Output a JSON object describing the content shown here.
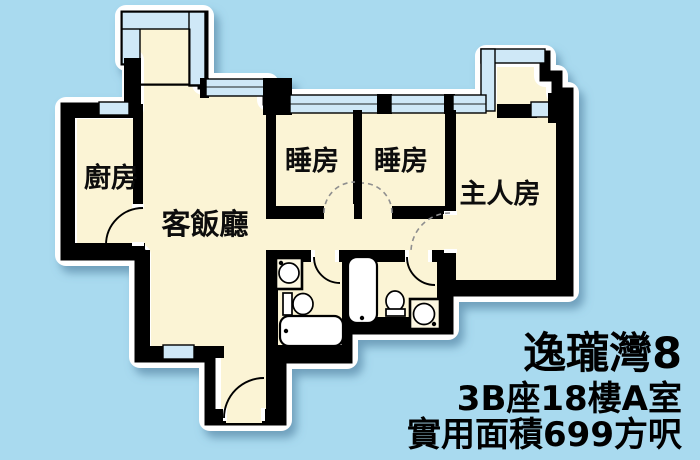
{
  "background_color": "#a9daef",
  "plan": {
    "floor_color": "#fbf4d5",
    "wall_color": "#000000",
    "window_glass_color": "#cfe8f7",
    "outline_color": "#ffffff",
    "rooms": [
      {
        "id": "kitchen",
        "label": "廚房"
      },
      {
        "id": "living-dining",
        "label": "客飯廳"
      },
      {
        "id": "bedroom-1",
        "label": "睡房"
      },
      {
        "id": "bedroom-2",
        "label": "睡房"
      },
      {
        "id": "master-bedroom",
        "label": "主人房"
      }
    ],
    "fixtures": [
      "bathtub",
      "toilet",
      "wash-basin",
      "bathtub",
      "toilet",
      "wash-basin"
    ],
    "features": [
      "balcony-bay-window",
      "windows",
      "entrance-door",
      "room-doors"
    ]
  },
  "caption": {
    "title": "逸瓏灣8",
    "block_floor_flat": "3B座18樓A室",
    "area": "實用面積699方呎"
  }
}
